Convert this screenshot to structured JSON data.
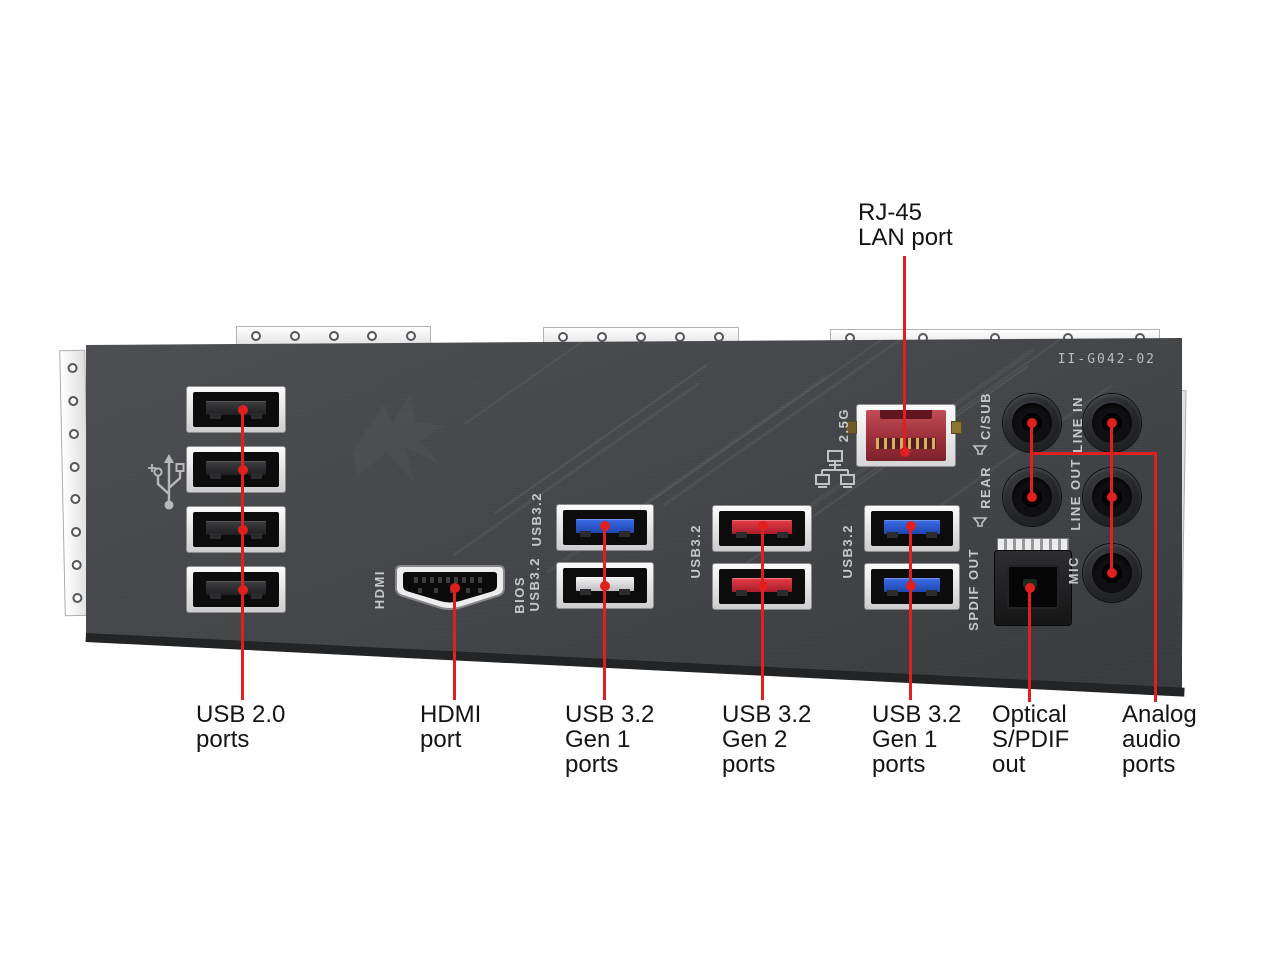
{
  "board": {
    "model_code": "II-G042-02"
  },
  "top_callout": {
    "text": "RJ-45\nLAN port"
  },
  "bottom_callouts": [
    {
      "id": "usb2",
      "text": "USB 2.0\nports"
    },
    {
      "id": "hdmi",
      "text": "HDMI\nport"
    },
    {
      "id": "usb32-gen1-left",
      "text": "USB 3.2\nGen 1\nports"
    },
    {
      "id": "usb32-gen2",
      "text": "USB 3.2\nGen 2\nports"
    },
    {
      "id": "usb32-gen1-right",
      "text": "USB 3.2\nGen 1\nports"
    },
    {
      "id": "optical-spdif",
      "text": "Optical\nS/PDIF\nout"
    },
    {
      "id": "analog-audio",
      "text": "Analog\naudio\nports"
    }
  ],
  "panel_labels": {
    "hdmi": "HDMI",
    "usb32_blue_top": "USB3.2",
    "bios_line1": "BIOS",
    "bios_line2": "USB3.2",
    "usb32_red_pair": "USB3.2",
    "usb32_right_pair": "USB3.2",
    "lan_speed": "2.5G",
    "audio_csub": "C/SUB",
    "audio_rear": "REAR",
    "audio_line_in": "LINE IN",
    "audio_line_out": "LINE OUT",
    "audio_mic": "MIC",
    "spdif": "SPDIF OUT"
  },
  "icons": {
    "usb": "usb-trident-icon",
    "lan": "network-nodes-icon",
    "speaker": "speaker-icon"
  },
  "colors": {
    "callout_red": "#e01f1f",
    "panel_gray": "#434549",
    "usb_gen1_blue": "#2a55c8",
    "usb_gen2_red": "#c4252f",
    "lan_port_red": "#a2343f",
    "silkscreen_gray": "#c6c8ca"
  }
}
